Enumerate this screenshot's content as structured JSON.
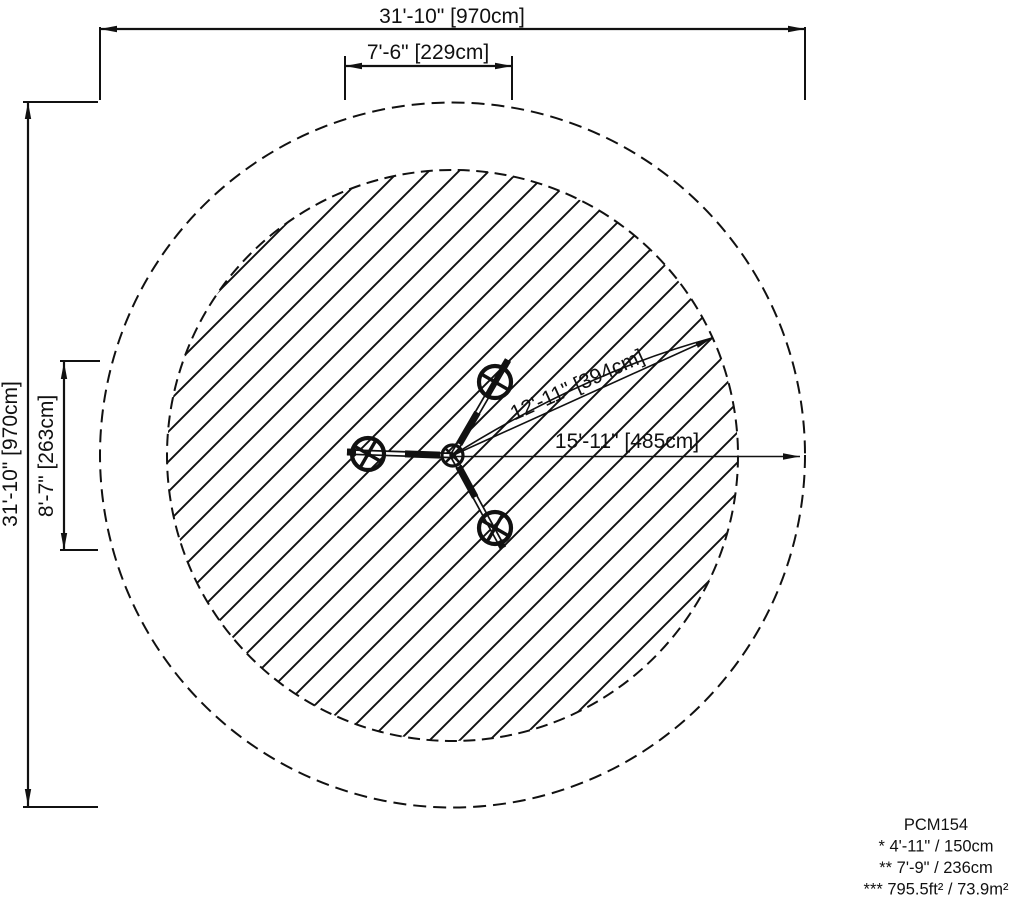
{
  "colors": {
    "ink": "#111111",
    "paper": "#ffffff"
  },
  "dimensions": {
    "overall_width": "31'-10\" [970cm]",
    "overall_height": "31'-10\" [970cm]",
    "equipment_width": "7'-6\" [229cm]",
    "equipment_height": "8'-7\" [263cm]",
    "use_zone_radius": "12'-11\" [394cm]",
    "safety_zone_radius": "15'-11\" [485cm]"
  },
  "legend": {
    "model_code": "PCM154",
    "note_1": "* 4'-11\" / 150cm",
    "note_2": "** 7'-9\" / 236cm",
    "note_3": "*** 795.5ft² / 73.9m²"
  }
}
